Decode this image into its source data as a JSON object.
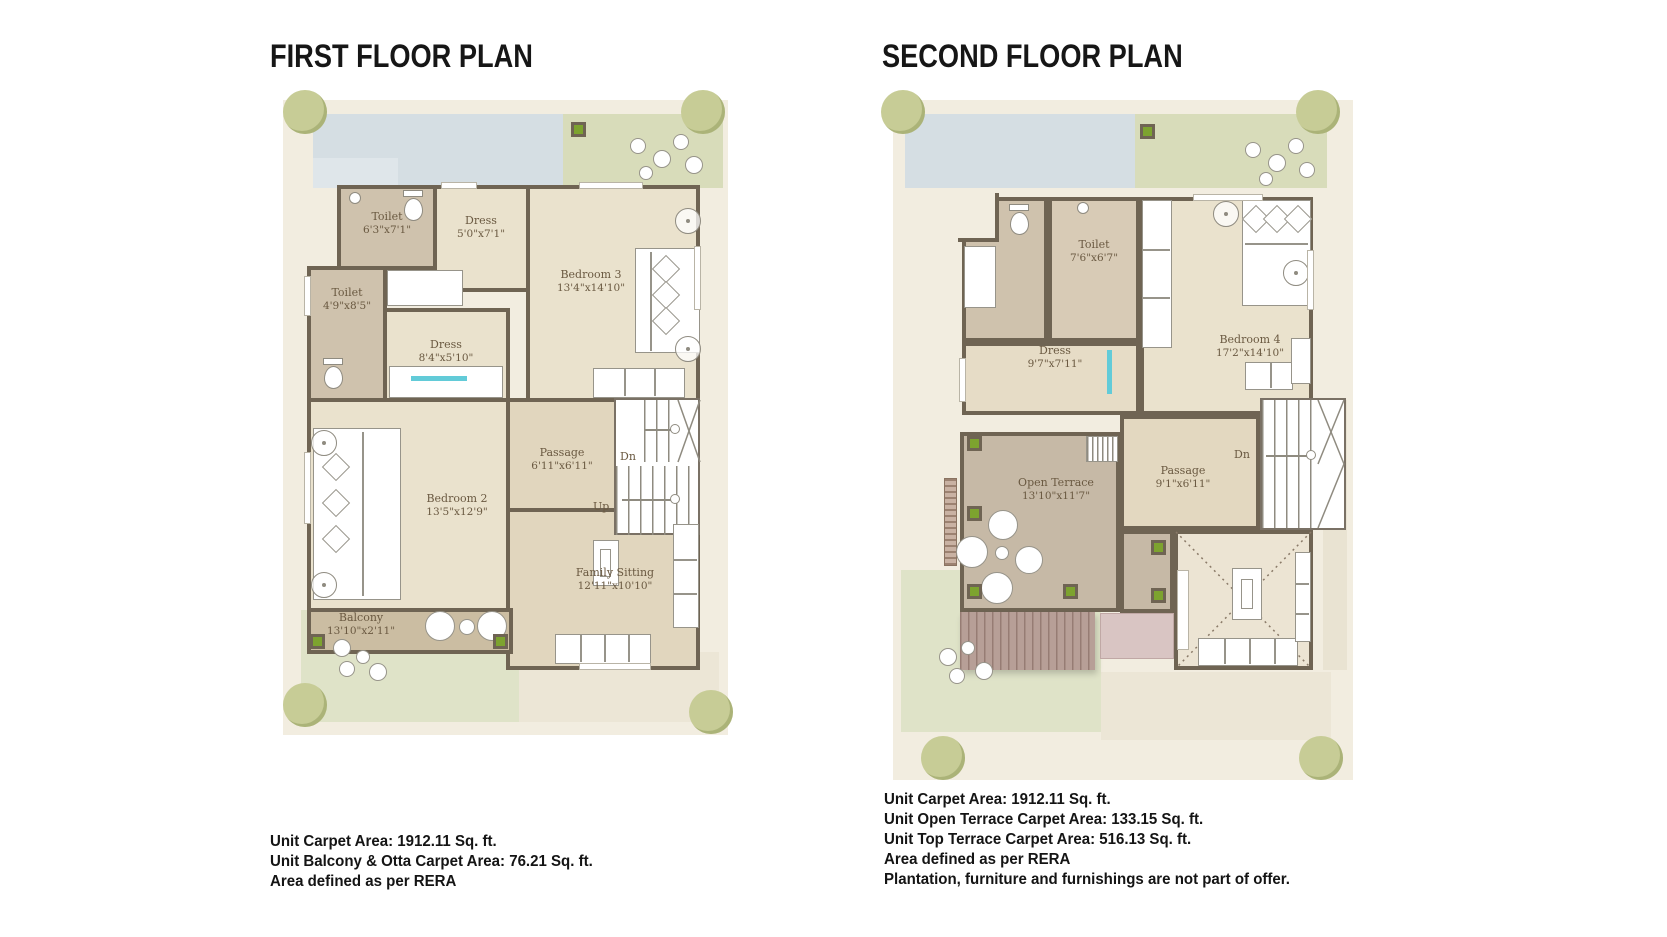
{
  "first_floor": {
    "title": "FIRST FLOOR PLAN",
    "rooms": {
      "toilet_a": {
        "name": "Toilet",
        "dims": "6'3\"x7'1\""
      },
      "dress_a": {
        "name": "Dress",
        "dims": "5'0\"x7'1\""
      },
      "bedroom3": {
        "name": "Bedroom 3",
        "dims": "13'4\"x14'10\""
      },
      "toilet_b": {
        "name": "Toilet",
        "dims": "4'9\"x8'5\""
      },
      "dress_b": {
        "name": "Dress",
        "dims": "8'4\"x5'10\""
      },
      "bedroom2": {
        "name": "Bedroom 2",
        "dims": "13'5\"x12'9\""
      },
      "passage": {
        "name": "Passage",
        "dims": "6'11\"x6'11\""
      },
      "family_sitting": {
        "name": "Family Sitting",
        "dims": "12'11\"x10'10\""
      },
      "balcony": {
        "name": "Balcony",
        "dims": "13'10\"x2'11\""
      }
    },
    "stairs": {
      "down_label": "Dn",
      "up_label": "Up"
    },
    "footer": {
      "line1": "Unit Carpet Area: 1912.11 Sq. ft.",
      "line2": "Unit Balcony & Otta Carpet Area: 76.21 Sq. ft.",
      "line3": "Area defined as per RERA"
    }
  },
  "second_floor": {
    "title": "SECOND FLOOR PLAN",
    "rooms": {
      "toilet": {
        "name": "Toilet",
        "dims": "7'6\"x6'7\""
      },
      "dress": {
        "name": "Dress",
        "dims": "9'7\"x7'11\""
      },
      "bedroom4": {
        "name": "Bedroom 4",
        "dims": "17'2\"x14'10\""
      },
      "open_terrace": {
        "name": "Open Terrace",
        "dims": "13'10\"x11'7\""
      },
      "passage": {
        "name": "Passage",
        "dims": "9'1\"x6'11\""
      }
    },
    "stairs": {
      "down_label": "Dn"
    },
    "footer": {
      "line1": "Unit Carpet Area: 1912.11 Sq. ft.",
      "line2": "Unit Open Terrace Carpet Area: 133.15 Sq. ft.",
      "line3": "Unit Top Terrace Carpet Area: 516.13 Sq. ft.",
      "line4": "Area defined as per RERA",
      "line5": "Plantation, furniture and furnishings are not part of offer."
    }
  },
  "colors": {
    "wall": "#6f6453",
    "room_floor": "#eae2cd",
    "toilet_floor": "#cfc2ad",
    "terrace_floor": "#c6b9a6",
    "balcony_floor": "#cbbda2",
    "lawn_green": "#dfe3c8",
    "paving_blue": "#d5dee3",
    "planter_green": "#7da32f",
    "label_brown": "#6a5941"
  }
}
